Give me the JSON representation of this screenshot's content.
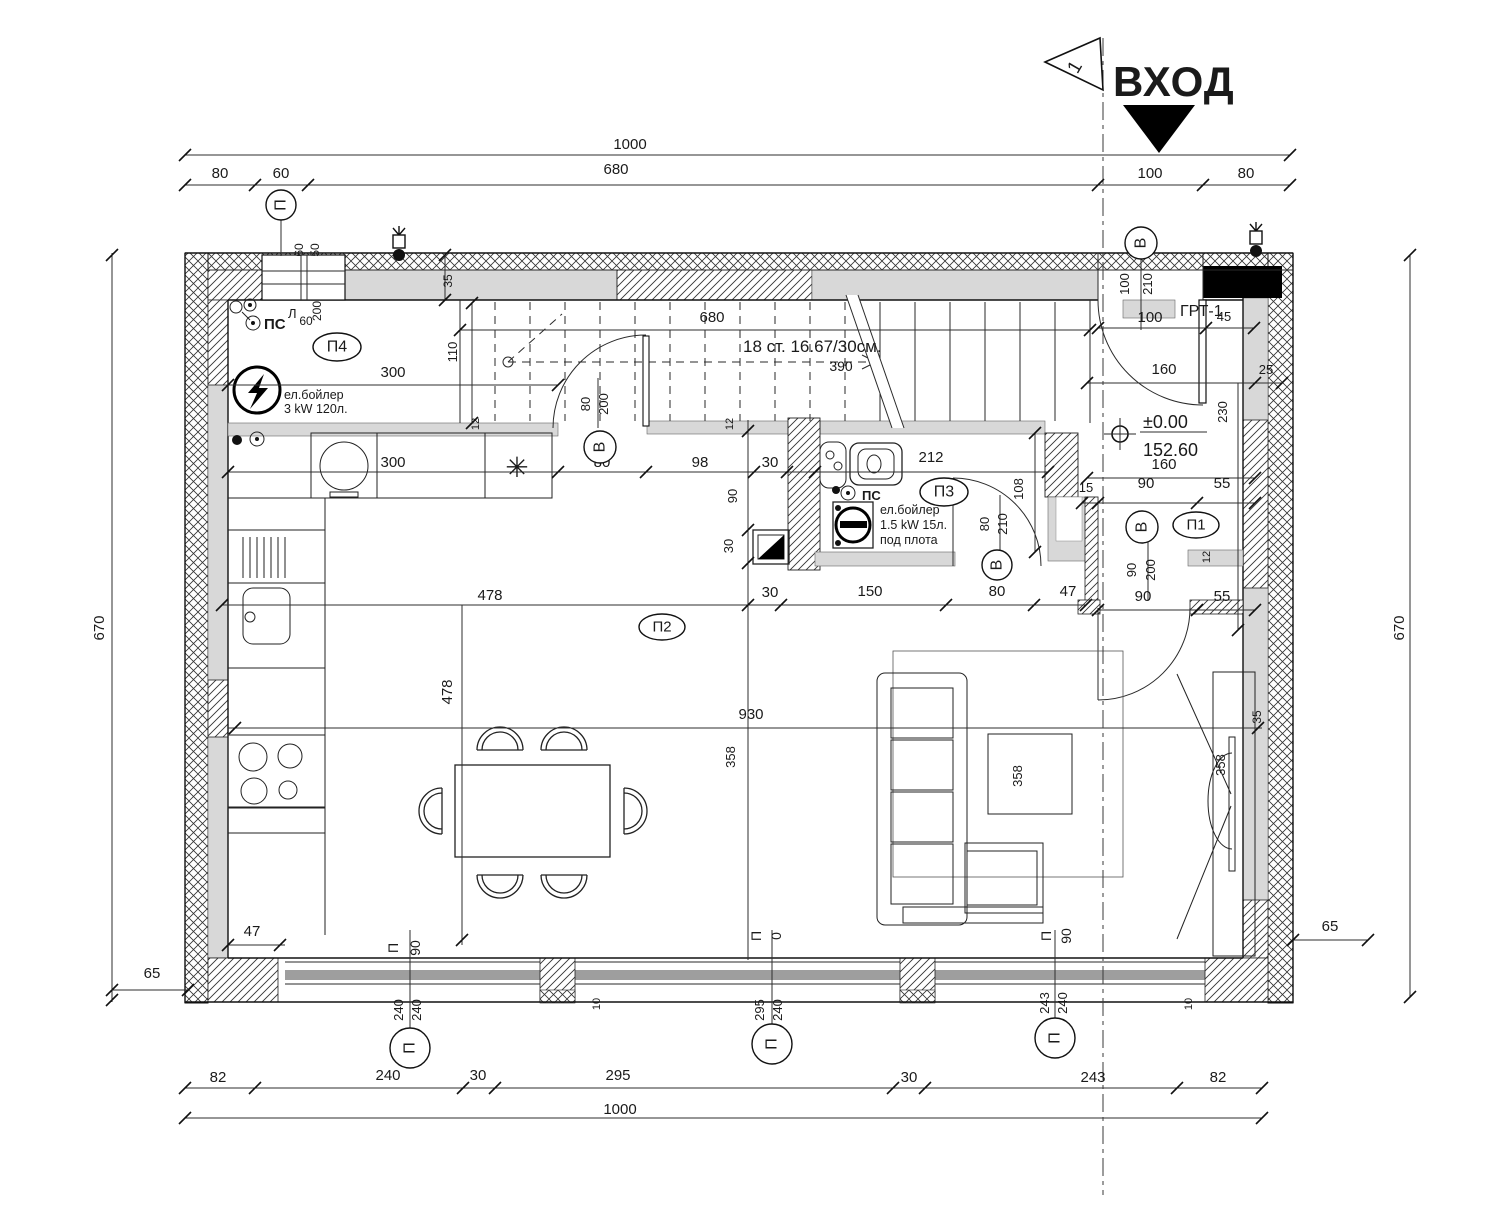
{
  "entrance": {
    "label": "ВХОД",
    "flag_number": "1"
  },
  "annotations": {
    "stairs_note": "18 ст. 16.67/30см.",
    "level_value": "±0.00",
    "level_elevation": "152.60",
    "grt_label": "ГРТ-1",
    "kitchen_boiler_line1": "ел.бойлер",
    "kitchen_boiler_line2": "3 kW  120л.",
    "bath_boiler_line1": "ел.бойлер",
    "bath_boiler_line2": "1.5 kW  15л.",
    "bath_boiler_line3": "под плота",
    "ps_kitchen": "ПС",
    "ps_bath": "ПС",
    "lamp_label": "Л",
    "fridge_symbol": "✳"
  },
  "axis_tags": [
    {
      "t": "П",
      "x": 281,
      "y": 205,
      "rx": 15,
      "ry": 15,
      "rot": -90
    },
    {
      "t": "В",
      "x": 1141,
      "y": 243,
      "rx": 16,
      "ry": 16,
      "rot": -90
    },
    {
      "t": "П4",
      "x": 337,
      "y": 347,
      "rx": 24,
      "ry": 14,
      "rot": 0
    },
    {
      "t": "В",
      "x": 600,
      "y": 447,
      "rx": 16,
      "ry": 16,
      "rot": -90
    },
    {
      "t": "П3",
      "x": 944,
      "y": 492,
      "rx": 24,
      "ry": 14,
      "rot": 0
    },
    {
      "t": "В",
      "x": 997,
      "y": 565,
      "rx": 15,
      "ry": 15,
      "rot": -90
    },
    {
      "t": "В",
      "x": 1142,
      "y": 527,
      "rx": 16,
      "ry": 16,
      "rot": -90
    },
    {
      "t": "П1",
      "x": 1196,
      "y": 525,
      "rx": 23,
      "ry": 13,
      "rot": 0
    },
    {
      "t": "П2",
      "x": 662,
      "y": 627,
      "rx": 23,
      "ry": 13,
      "rot": 0
    },
    {
      "t": "П",
      "x": 410,
      "y": 1048,
      "rx": 20,
      "ry": 20,
      "rot": -90
    },
    {
      "t": "П",
      "x": 772,
      "y": 1044,
      "rx": 20,
      "ry": 20,
      "rot": -90
    },
    {
      "t": "П",
      "x": 1055,
      "y": 1038,
      "rx": 20,
      "ry": 20,
      "rot": -90
    }
  ],
  "dim_labels": [
    {
      "t": "1000",
      "x": 630,
      "y": 149
    },
    {
      "t": "80",
      "x": 220,
      "y": 178
    },
    {
      "t": "60",
      "x": 281,
      "y": 178
    },
    {
      "t": "680",
      "x": 616,
      "y": 174
    },
    {
      "t": "100",
      "x": 1150,
      "y": 178
    },
    {
      "t": "80",
      "x": 1246,
      "y": 178
    },
    {
      "t": "60",
      "x": 303,
      "y": 250,
      "r": -90,
      "s": 12
    },
    {
      "t": "50",
      "x": 319,
      "y": 250,
      "r": -90,
      "s": 12
    },
    {
      "t": "35",
      "x": 452,
      "y": 281,
      "r": -90,
      "s": 12
    },
    {
      "t": "60",
      "x": 306,
      "y": 325,
      "s": 12
    },
    {
      "t": "200",
      "x": 321,
      "y": 311,
      "r": -90,
      "s": 12
    },
    {
      "t": "300",
      "x": 393,
      "y": 377
    },
    {
      "t": "110",
      "x": 457,
      "y": 352,
      "r": -90,
      "s": 13
    },
    {
      "t": "680",
      "x": 712,
      "y": 322
    },
    {
      "t": "390",
      "x": 841,
      "y": 371,
      "s": 14
    },
    {
      "t": "80",
      "x": 590,
      "y": 404,
      "r": -90,
      "s": 13
    },
    {
      "t": "200",
      "x": 608,
      "y": 404,
      "r": -90,
      "s": 13
    },
    {
      "t": "12",
      "x": 479,
      "y": 424,
      "r": -90,
      "s": 11
    },
    {
      "t": "12",
      "x": 733,
      "y": 424,
      "r": -90,
      "s": 11
    },
    {
      "t": "300",
      "x": 393,
      "y": 467
    },
    {
      "t": "80",
      "x": 602,
      "y": 467
    },
    {
      "t": "98",
      "x": 700,
      "y": 467
    },
    {
      "t": "30",
      "x": 770,
      "y": 467
    },
    {
      "t": "212",
      "x": 931,
      "y": 462
    },
    {
      "t": "90",
      "x": 737,
      "y": 496,
      "r": -90,
      "s": 13
    },
    {
      "t": "30",
      "x": 733,
      "y": 546,
      "r": -90,
      "s": 13
    },
    {
      "t": "108",
      "x": 1023,
      "y": 489,
      "r": -90,
      "s": 13
    },
    {
      "t": "80",
      "x": 989,
      "y": 524,
      "r": -90,
      "s": 13
    },
    {
      "t": "210",
      "x": 1007,
      "y": 524,
      "r": -90,
      "s": 13
    },
    {
      "t": "100",
      "x": 1150,
      "y": 322
    },
    {
      "t": "45",
      "x": 1224,
      "y": 321,
      "s": 13
    },
    {
      "t": "100",
      "x": 1129,
      "y": 284,
      "r": -90,
      "s": 13
    },
    {
      "t": "210",
      "x": 1152,
      "y": 284,
      "r": -90,
      "s": 13
    },
    {
      "t": "160",
      "x": 1164,
      "y": 374
    },
    {
      "t": "25",
      "x": 1266,
      "y": 374,
      "s": 13
    },
    {
      "t": "230",
      "x": 1227,
      "y": 412,
      "r": -90,
      "s": 13
    },
    {
      "t": "160",
      "x": 1164,
      "y": 469
    },
    {
      "t": "15",
      "x": 1086,
      "y": 492,
      "s": 13
    },
    {
      "t": "90",
      "x": 1146,
      "y": 488
    },
    {
      "t": "55",
      "x": 1222,
      "y": 488
    },
    {
      "t": "90",
      "x": 1136,
      "y": 570,
      "r": -90,
      "s": 13
    },
    {
      "t": "200",
      "x": 1155,
      "y": 570,
      "r": -90,
      "s": 13
    },
    {
      "t": "12",
      "x": 1210,
      "y": 557,
      "r": -90,
      "s": 11
    },
    {
      "t": "90",
      "x": 1143,
      "y": 601
    },
    {
      "t": "55",
      "x": 1222,
      "y": 601
    },
    {
      "t": "478",
      "x": 490,
      "y": 600
    },
    {
      "t": "478",
      "x": 452,
      "y": 692,
      "r": -90
    },
    {
      "t": "930",
      "x": 751,
      "y": 719
    },
    {
      "t": "358",
      "x": 735,
      "y": 757,
      "r": -90,
      "s": 13
    },
    {
      "t": "358",
      "x": 1022,
      "y": 776,
      "r": -90,
      "s": 13
    },
    {
      "t": "358",
      "x": 1225,
      "y": 765,
      "r": -90,
      "s": 13
    },
    {
      "t": "30",
      "x": 770,
      "y": 597
    },
    {
      "t": "150",
      "x": 870,
      "y": 596
    },
    {
      "t": "80",
      "x": 997,
      "y": 596
    },
    {
      "t": "47",
      "x": 1068,
      "y": 596
    },
    {
      "t": "35",
      "x": 1261,
      "y": 717,
      "r": -90,
      "s": 12
    },
    {
      "t": "47",
      "x": 252,
      "y": 936
    },
    {
      "t": "П",
      "x": 398,
      "y": 948,
      "r": -90,
      "s": 14
    },
    {
      "t": "90",
      "x": 420,
      "y": 948,
      "r": -90,
      "s": 14
    },
    {
      "t": "П",
      "x": 761,
      "y": 936,
      "r": -90,
      "s": 14
    },
    {
      "t": "0",
      "x": 781,
      "y": 936,
      "r": -90,
      "s": 14
    },
    {
      "t": "П",
      "x": 1051,
      "y": 936,
      "r": -90,
      "s": 14
    },
    {
      "t": "90",
      "x": 1071,
      "y": 936,
      "r": -90,
      "s": 14
    },
    {
      "t": "240",
      "x": 403,
      "y": 1010,
      "r": -90,
      "s": 13
    },
    {
      "t": "240",
      "x": 421,
      "y": 1010,
      "r": -90,
      "s": 13
    },
    {
      "t": "295",
      "x": 764,
      "y": 1010,
      "r": -90,
      "s": 13
    },
    {
      "t": "240",
      "x": 782,
      "y": 1010,
      "r": -90,
      "s": 13
    },
    {
      "t": "243",
      "x": 1049,
      "y": 1003,
      "r": -90,
      "s": 13
    },
    {
      "t": "240",
      "x": 1067,
      "y": 1003,
      "r": -90,
      "s": 13
    },
    {
      "t": "10",
      "x": 600,
      "y": 1004,
      "r": -90,
      "s": 11
    },
    {
      "t": "10",
      "x": 1192,
      "y": 1004,
      "r": -90,
      "s": 11
    },
    {
      "t": "82",
      "x": 218,
      "y": 1082
    },
    {
      "t": "240",
      "x": 388,
      "y": 1080
    },
    {
      "t": "30",
      "x": 478,
      "y": 1080
    },
    {
      "t": "295",
      "x": 618,
      "y": 1080
    },
    {
      "t": "30",
      "x": 909,
      "y": 1082
    },
    {
      "t": "243",
      "x": 1093,
      "y": 1082
    },
    {
      "t": "82",
      "x": 1218,
      "y": 1082
    },
    {
      "t": "1000",
      "x": 620,
      "y": 1114
    },
    {
      "t": "670",
      "x": 104,
      "y": 628,
      "r": -90
    },
    {
      "t": "65",
      "x": 152,
      "y": 978
    },
    {
      "t": "670",
      "x": 1404,
      "y": 628,
      "r": -90
    },
    {
      "t": "65",
      "x": 1330,
      "y": 931
    }
  ],
  "ticks": [
    [
      185,
      155
    ],
    [
      1290,
      155
    ],
    [
      185,
      185
    ],
    [
      255,
      185
    ],
    [
      308,
      185
    ],
    [
      1098,
      185
    ],
    [
      1203,
      185
    ],
    [
      1290,
      185
    ],
    [
      460,
      330
    ],
    [
      1090,
      330
    ],
    [
      228,
      385
    ],
    [
      558,
      385
    ],
    [
      472,
      303
    ],
    [
      472,
      423
    ],
    [
      445,
      255
    ],
    [
      445,
      300
    ],
    [
      228,
      472
    ],
    [
      558,
      472
    ],
    [
      646,
      472
    ],
    [
      754,
      472
    ],
    [
      787,
      472
    ],
    [
      815,
      472
    ],
    [
      1048,
      472
    ],
    [
      748,
      431
    ],
    [
      748,
      530
    ],
    [
      748,
      563
    ],
    [
      222,
      605
    ],
    [
      748,
      605
    ],
    [
      781,
      605
    ],
    [
      946,
      605
    ],
    [
      1034,
      605
    ],
    [
      1086,
      605
    ],
    [
      462,
      940
    ],
    [
      235,
      728
    ],
    [
      1258,
      728
    ],
    [
      228,
      945
    ],
    [
      280,
      945
    ],
    [
      1035,
      433
    ],
    [
      1035,
      552
    ],
    [
      1098,
      328
    ],
    [
      1206,
      328
    ],
    [
      1254,
      328
    ],
    [
      1087,
      383
    ],
    [
      1255,
      383
    ],
    [
      1282,
      383
    ],
    [
      1238,
      630
    ],
    [
      1087,
      478
    ],
    [
      1255,
      478
    ],
    [
      1082,
      503
    ],
    [
      1098,
      503
    ],
    [
      1197,
      503
    ],
    [
      1255,
      503
    ],
    [
      1098,
      610
    ],
    [
      1197,
      610
    ],
    [
      1255,
      610
    ],
    [
      112,
      255
    ],
    [
      112,
      1000
    ],
    [
      112,
      990
    ],
    [
      188,
      990
    ],
    [
      1410,
      255
    ],
    [
      1410,
      997
    ],
    [
      1293,
      940
    ],
    [
      1368,
      940
    ],
    [
      185,
      1088
    ],
    [
      255,
      1088
    ],
    [
      463,
      1088
    ],
    [
      495,
      1088
    ],
    [
      893,
      1088
    ],
    [
      925,
      1088
    ],
    [
      1177,
      1088
    ],
    [
      1262,
      1088
    ],
    [
      185,
      1118
    ],
    [
      1262,
      1118
    ]
  ],
  "colors": {
    "wall_gray": "#d8d8d8",
    "sill_gray": "#9e9e9e",
    "line": "#1c1c1c"
  }
}
